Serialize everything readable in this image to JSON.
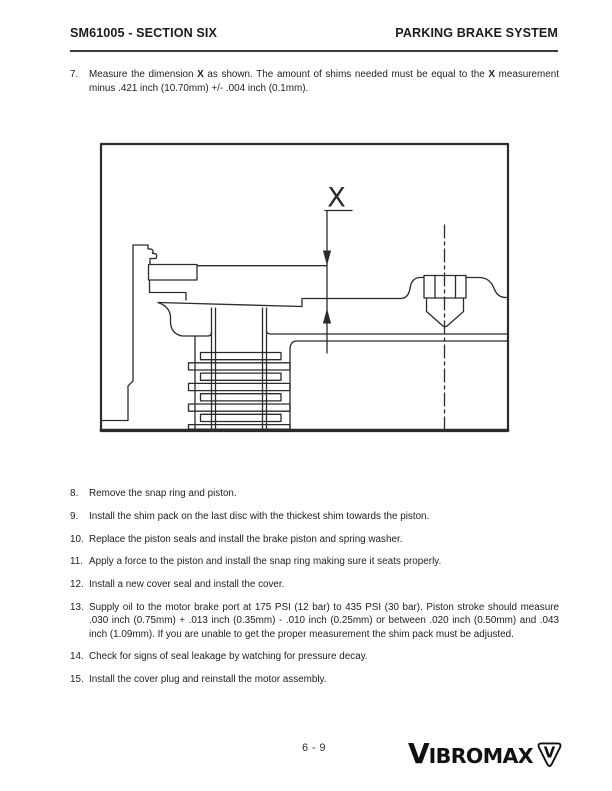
{
  "page": {
    "background": "#ffffff",
    "ink": "#1f1f1f",
    "line_color": "#2b2b2b"
  },
  "header": {
    "doc_code": "SM61005 - SECTION SIX",
    "section_title": "PARKING BRAKE SYSTEM"
  },
  "step7": {
    "num": "7.",
    "t0": "Measure the dimension ",
    "b0": "X",
    "t1": " as shown. The amount of shims needed must be equal to the ",
    "b1": "X",
    "t2": " mea­surement minus .421 inch (10.70mm) +/-  .004 inch (0.1mm)."
  },
  "figure": {
    "description": "Cross-section of brake assembly showing dimension X between piston surface and cover surface",
    "dimension_label": "X"
  },
  "steps": [
    {
      "num": "8.",
      "text": "Remove the snap ring and piston."
    },
    {
      "num": "9.",
      "text": "Install the shim pack on the last disc with the thickest shim towards the piston."
    },
    {
      "num": "10.",
      "text": "Replace the piston seals and install the brake piston and spring washer."
    },
    {
      "num": "11.",
      "text": "Apply a force to the piston and install the snap ring making sure it seats properly."
    },
    {
      "num": "12.",
      "text": "Install a new cover seal and install the cover."
    },
    {
      "num": "13.",
      "text": "Supply oil to the motor brake port at 175 PSI (12 bar) to 435 PSI (30 bar). Piston stroke should measure .030 inch (0.75mm) + .013 inch (0.35mm) - .010 inch (0.25mm) or between .020 inch (0.50mm) and .043 inch (1.09mm). If you are unable to get the proper measurement the shim pack must be adjusted."
    },
    {
      "num": "14.",
      "text": "Check for signs of seal leakage by watching for pressure decay."
    },
    {
      "num": "15.",
      "text": "Install the cover plug and reinstall the motor assembly."
    }
  ],
  "footer": {
    "page_number": "6 - 9",
    "brand_initial": "V",
    "brand_rest": "IBROMAX",
    "badge_letter": "V"
  }
}
